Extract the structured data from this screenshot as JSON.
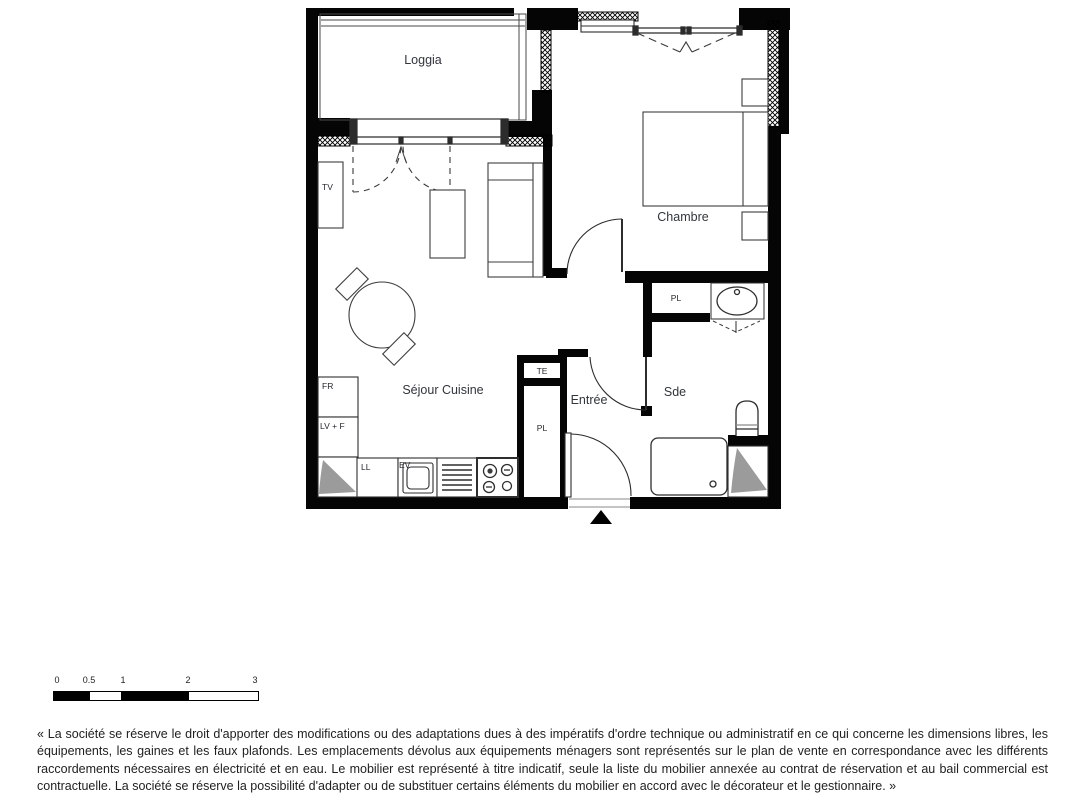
{
  "plan": {
    "rooms": {
      "loggia": "Loggia",
      "chambre": "Chambre",
      "sejour_cuisine": "Séjour Cuisine",
      "entree": "Entrée",
      "sde": "Sde"
    },
    "fixtures": {
      "tv": "TV",
      "fridge": "FR",
      "dishwasher_oven": "LV + F",
      "washer": "LL",
      "sink": "EV",
      "electrical_panel": "TE",
      "closet_entree": "PL",
      "closet_chambre": "PL"
    }
  },
  "scale_bar": {
    "ticks": [
      "0",
      "0.5",
      "1",
      "2",
      "3"
    ]
  },
  "disclaimer": {
    "text": "« La société se réserve le droit d'apporter des modifications ou des adaptations dues à des impératifs d'ordre technique ou administratif en ce qui concerne les dimensions libres, les équipements, les gaines et les faux plafonds. Les emplacements dévolus aux équipements ménagers sont représentés sur le plan de vente en correspondance avec les différents raccordements nécessaires en électricité et en eau. Le mobilier est représenté à titre indicatif, seule la liste du mobilier annexée au contrat de réservation et au bail commercial est contractuelle. La société se réserve la possibilité d'adapter ou de substituer certains éléments du mobilier en accord avec le décorateur et le gestionnaire. »"
  },
  "colors": {
    "wall": "#000000",
    "gaine_fill": "#9b9b9b",
    "thin_line": "#333333",
    "label_text": "#31363c",
    "disclaimer_text": "#1f1f1f"
  }
}
